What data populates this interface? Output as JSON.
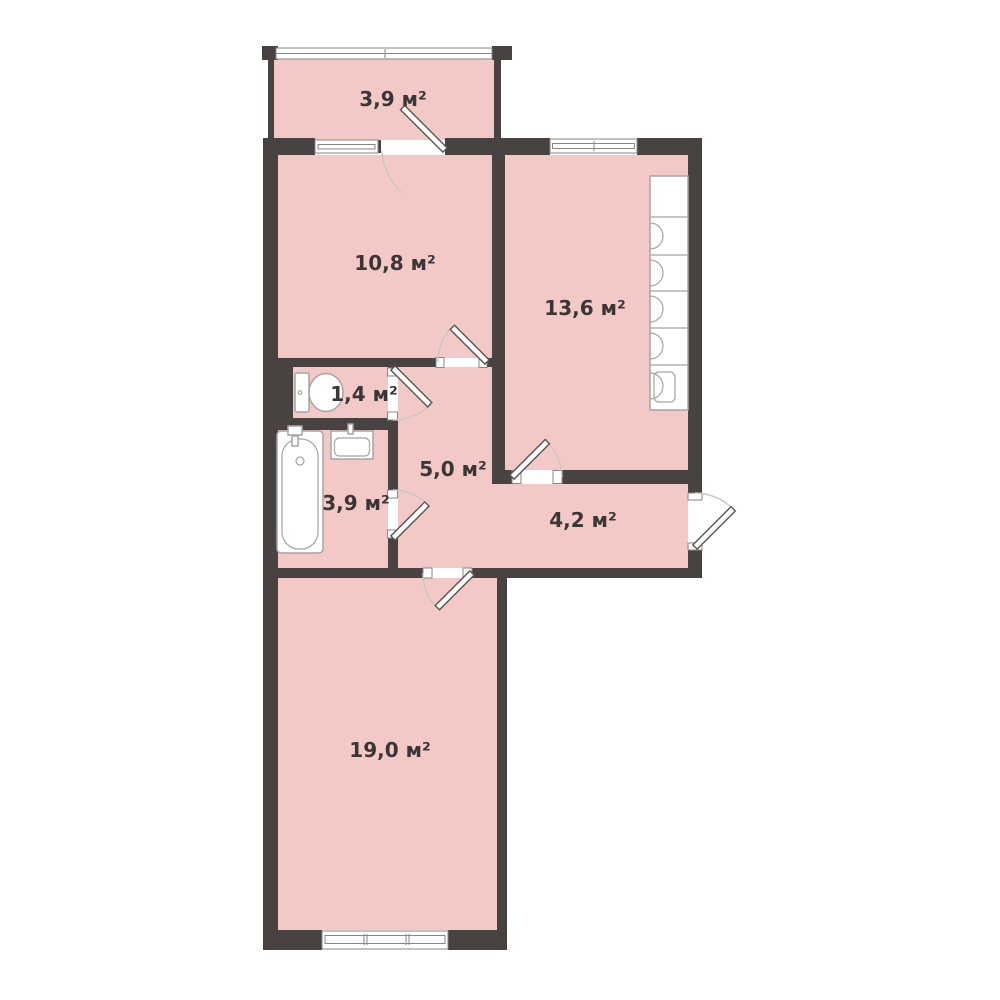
{
  "plan": {
    "type": "apartment-floor-plan",
    "unit": "м²",
    "rooms": [
      {
        "id": "balcony",
        "area": "3,9 м²"
      },
      {
        "id": "bedroom",
        "area": "10,8 м²"
      },
      {
        "id": "kitchen",
        "area": "13,6 м²"
      },
      {
        "id": "wc",
        "area": "1,4 м²"
      },
      {
        "id": "hallway",
        "area": "5,0 м²"
      },
      {
        "id": "bathroom",
        "area": "3,9 м²"
      },
      {
        "id": "entry-hall",
        "area": "4,2 м²"
      },
      {
        "id": "living-room",
        "area": "19,0 м²"
      }
    ],
    "colors": {
      "wall": "#484340",
      "floor": "#f3c9c8",
      "background": "#ffffff",
      "label_text": "#3b3636"
    }
  }
}
